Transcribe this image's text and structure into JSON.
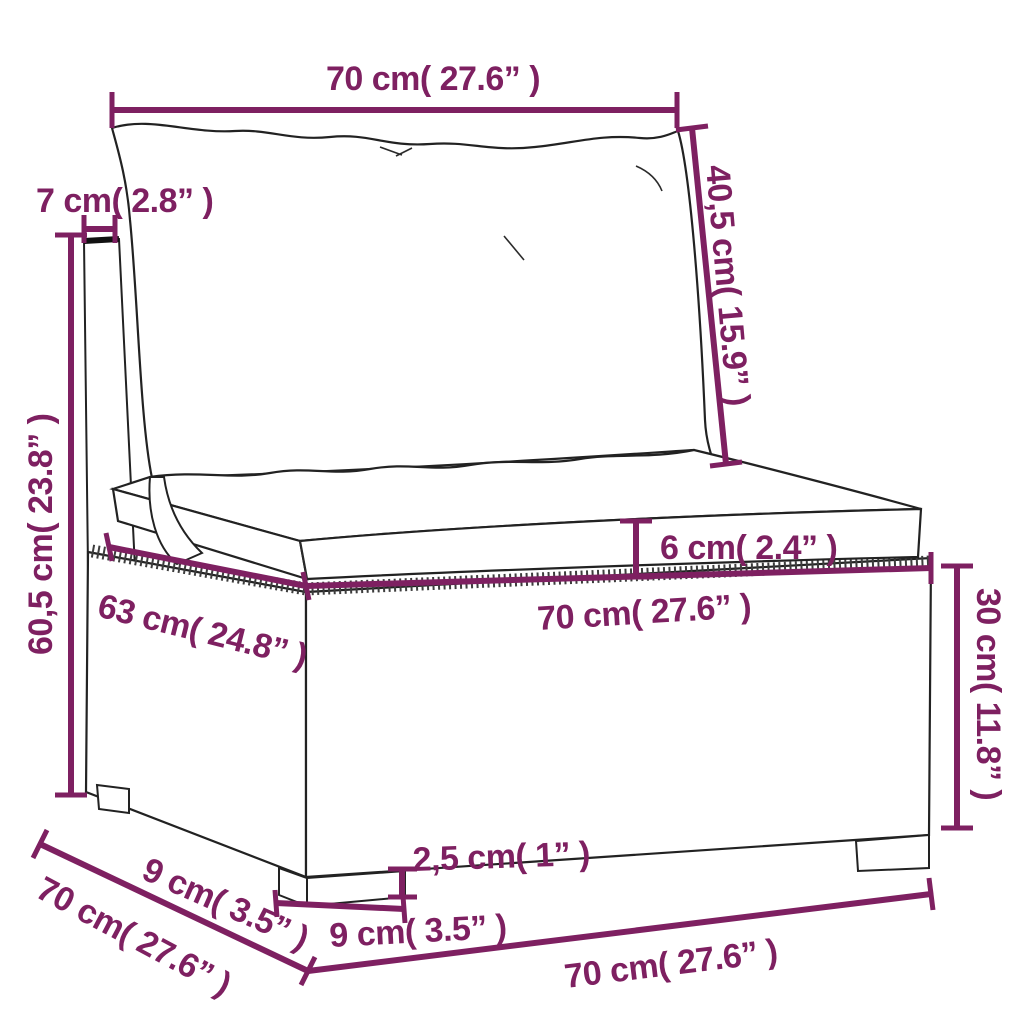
{
  "title": "Rattan sofa section dimension diagram",
  "colors": {
    "dimension_accent": "#7e2061",
    "line_art": "#222222",
    "background": "#ffffff"
  },
  "dimensions": {
    "back_width": "70 cm( 27.6” )",
    "back_frame_depth": "7 cm( 2.8” )",
    "back_cushion_height": "40,5 cm( 15.9” )",
    "total_height": "60,5 cm( 23.8” )",
    "seat_cushion_thickness": "6 cm( 2.4” )",
    "seat_depth": "63 cm( 24.8” )",
    "seat_width": "70 cm( 27.6” )",
    "base_height": "30 cm( 11.8” )",
    "leg_inset_depth": "9 cm( 3.5” )",
    "depth_total": "70 cm( 27.6” )",
    "leg_height": "2,5 cm( 1” )",
    "leg_width": "9 cm( 3.5” )",
    "front_width": "70 cm( 27.6” )"
  }
}
